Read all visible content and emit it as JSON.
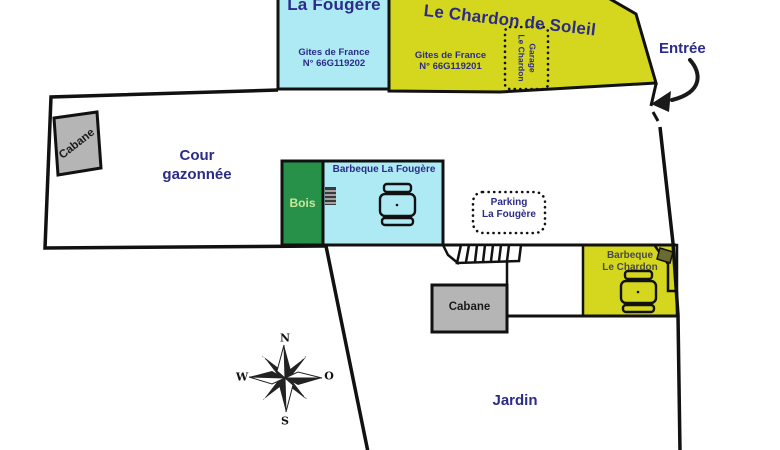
{
  "map": {
    "buildings": {
      "la_fougere": {
        "title": "La Fougère",
        "org": "Gites de France",
        "number": "N° 66G119202"
      },
      "le_chardon": {
        "title": "Le Chardon de Soleil",
        "org": "Gites de France",
        "number": "N° 66G119201"
      }
    },
    "labels": {
      "entree": "Entrée",
      "cour_line1": "Cour",
      "cour_line2": "gazonnée",
      "bois": "Bois",
      "bbq_fougere": "Barbeque La Fougère",
      "parking_line1": "Parking",
      "parking_line2": "La Fougère",
      "bbq_chardon_line1": "Barbeque",
      "bbq_chardon_line2": "Le Chardon",
      "garage_line1": "Garage",
      "garage_line2": "Le Chardon",
      "cabane_left": "Cabane",
      "cabane_bottom": "Cabane",
      "jardin": "Jardin"
    },
    "compass": {
      "n": "N",
      "s": "S",
      "w": "W",
      "o": "O"
    },
    "colors": {
      "cyan": "#aeeaf4",
      "yellow": "#d5d71f",
      "green": "#27914a",
      "gray": "#b5b5b5",
      "navy": "#2b2b88",
      "line": "#111111",
      "diamond": "#6a6b2e",
      "white": "#ffffff"
    }
  }
}
